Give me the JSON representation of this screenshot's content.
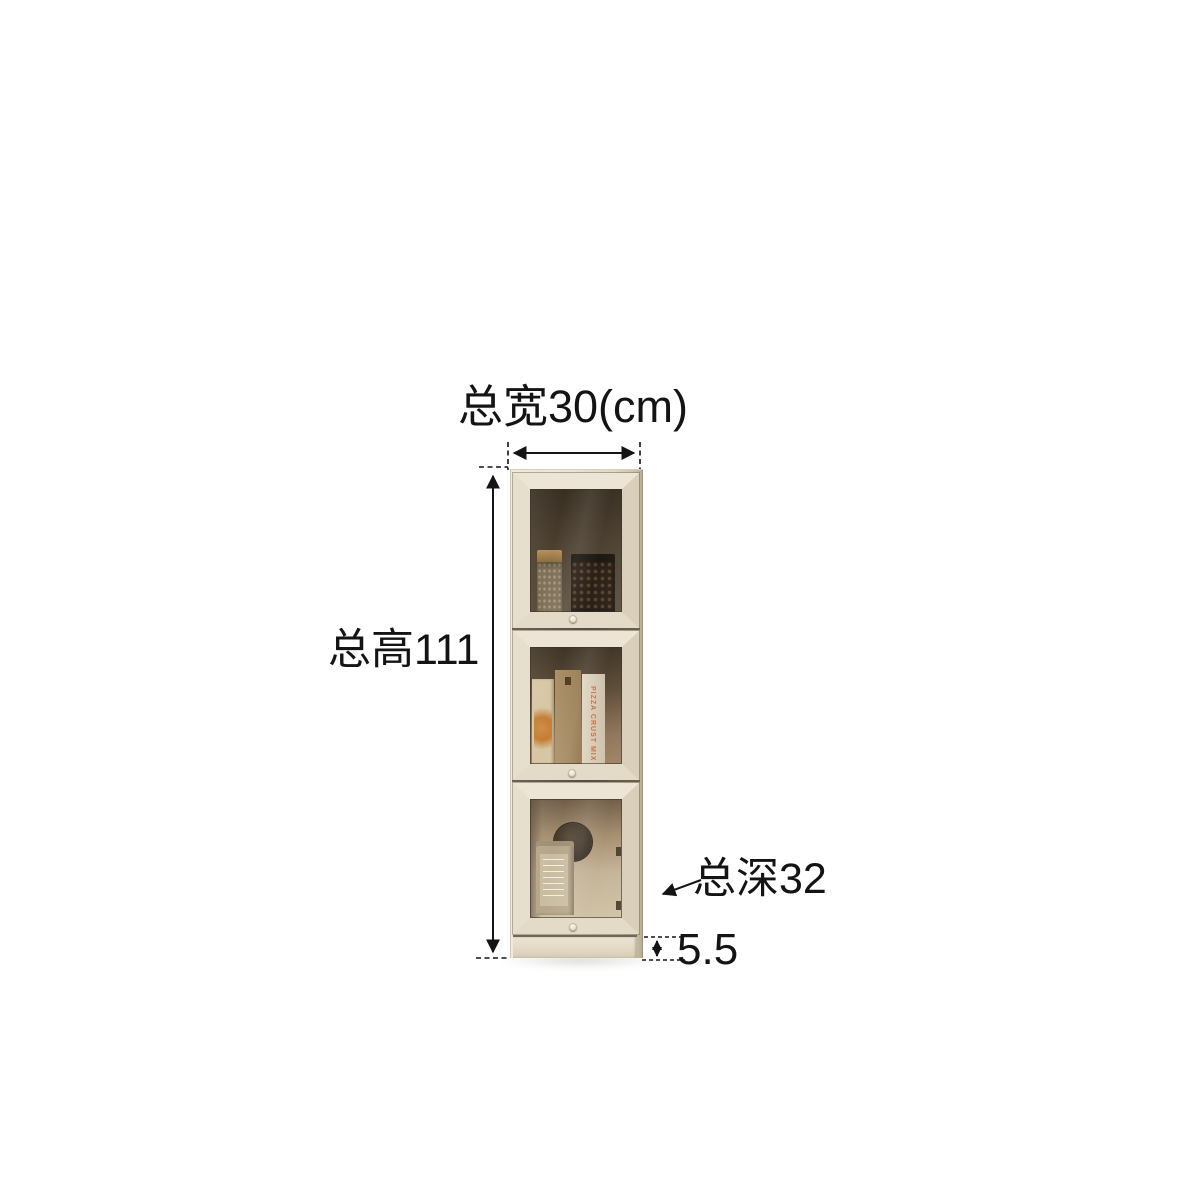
{
  "canvas": {
    "background": "#ffffff"
  },
  "annotations": {
    "width_label": "总宽30(cm)",
    "height_label": "总高111",
    "depth_label": "总深32",
    "base_height_label": "5.5"
  },
  "product": {
    "kind": "narrow three-door glass display side cabinet",
    "doors": 3,
    "pizza_box_text": "PIZZA CRUST MIX"
  },
  "colors": {
    "dimension_line": "#141414",
    "label_text": "#141414",
    "cabinet_frame_light": "#ece5d6",
    "cabinet_frame_shadow": "#c9bea6",
    "interior_dark_brown": "#463b2c",
    "interior_light_tan": "#c2b194"
  }
}
